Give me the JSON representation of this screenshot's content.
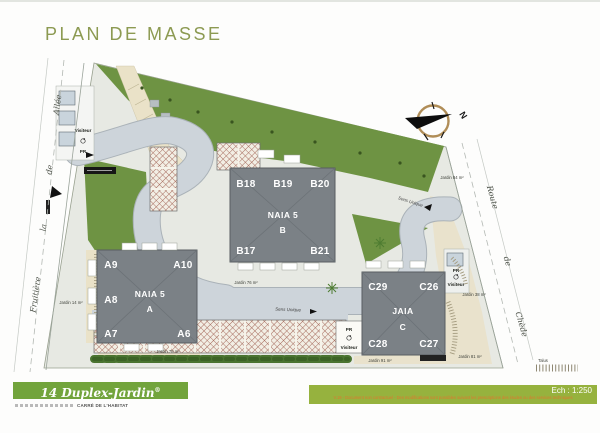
{
  "page": {
    "title": "PLAN DE MASSE"
  },
  "compass": {
    "north": "N"
  },
  "streets": {
    "left": {
      "words": [
        "Allée",
        "de",
        "la",
        "Fruitière"
      ]
    },
    "right": {
      "words": [
        "Route",
        "de",
        "Chède"
      ]
    }
  },
  "road_labels": {
    "one_way_a": "Sens Unique",
    "one_way_b": "Sens Unique"
  },
  "buildings": {
    "a": {
      "name": "NAIA 5",
      "letter": "A",
      "units": {
        "a9": "A9",
        "a10": "A10",
        "a8": "A8",
        "a7": "A7",
        "a6": "A6"
      }
    },
    "b": {
      "name": "NAIA 5",
      "letter": "B",
      "units": {
        "b18": "B18",
        "b19": "B19",
        "b20": "B20",
        "b17": "B17",
        "b21": "B21"
      }
    },
    "c": {
      "name": "JAIA",
      "letter": "C",
      "units": {
        "c29": "C29",
        "c26": "C26",
        "c28": "C28",
        "c27": "C27"
      }
    }
  },
  "gardens": {
    "g84": "Jardin 84 m²",
    "g14": "Jardin 14 m²",
    "g78": "Jardin 78 m²",
    "g76": "Jardin 76 m²",
    "g38": "Jardin 38 m²",
    "g81": "Jardin 81 m²",
    "g91": "Jardin 91 m²"
  },
  "visitors": {
    "left": {
      "label": "Visiteur",
      "pr": "PR"
    },
    "right": {
      "label": "Visiteur",
      "pr": "PR"
    },
    "bottom": {
      "label": "Visiteur",
      "pr": "PR"
    }
  },
  "legend": {
    "talus": "Talus"
  },
  "footer": {
    "banner_text": "14 Duplex-Jardin",
    "banner_reg": "®",
    "brand_text": "CARRÉ DE L'HABITAT",
    "scale_text": "Ech : 1:250",
    "disclaimer": "V.19 - Document non contractuel - Des modifications sont possibles suivant les prescriptions des études ou des services techniques"
  },
  "colors": {
    "title_green": "#8c9a52",
    "banner_green": "#72a43c",
    "bar_green": "#96b23e",
    "lawn_green": "#6e9343",
    "road_gray": "#cdd4da",
    "building_gray": "#7b8186",
    "hatch_red": "#a5695b",
    "disclaimer_orange": "#e0762e"
  }
}
